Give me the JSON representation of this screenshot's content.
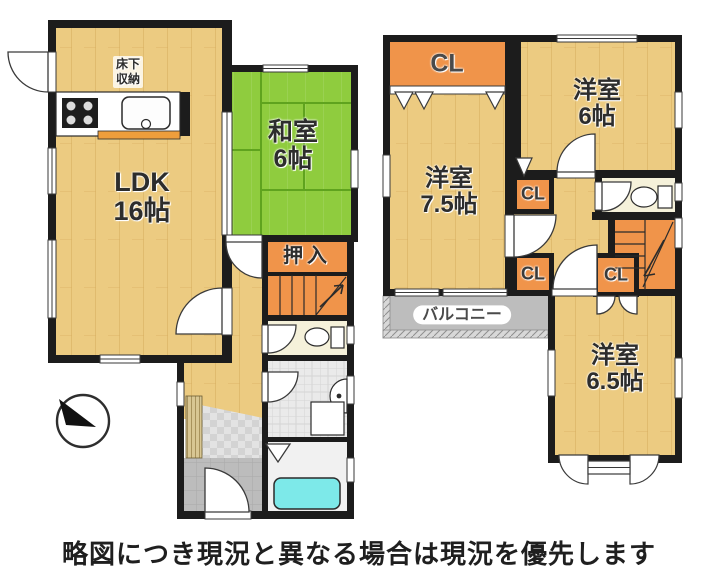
{
  "disclaimer": "略図につき現況と異なる場合は現況を優先します",
  "floor1": {
    "ldk": {
      "name": "LDK",
      "size": "16帖"
    },
    "washitsu": {
      "name": "和室",
      "size": "6帖"
    },
    "oshiire": "押入",
    "underfloor_storage": {
      "line1": "床下",
      "line2": "収納"
    }
  },
  "floor2": {
    "closet_top": "CL",
    "closet_mid": "CL",
    "closet_bottom_left": "CL",
    "closet_bottom_right": "CL",
    "bedroom_6": {
      "name": "洋室",
      "size": "6帖"
    },
    "bedroom_7_5": {
      "name": "洋室",
      "size": "7.5帖"
    },
    "bedroom_6_5": {
      "name": "洋室",
      "size": "6.5帖"
    },
    "balcony": "バルコニー"
  },
  "colors": {
    "wood": "#ECCB81",
    "wood_line": "#D6AC5E",
    "tatami": "#8FCC3E",
    "tatami_line": "#5FA31E",
    "closet": "#F0944A",
    "wall": "#1C1C1C",
    "toilet_floor": "#F5F1DA",
    "tub": "#7DE9E9",
    "balcony_gray": "#BDBDBD",
    "counter_edge": "#EE9E3C",
    "doma": "#BCBCBC",
    "step": "#D8C693"
  }
}
